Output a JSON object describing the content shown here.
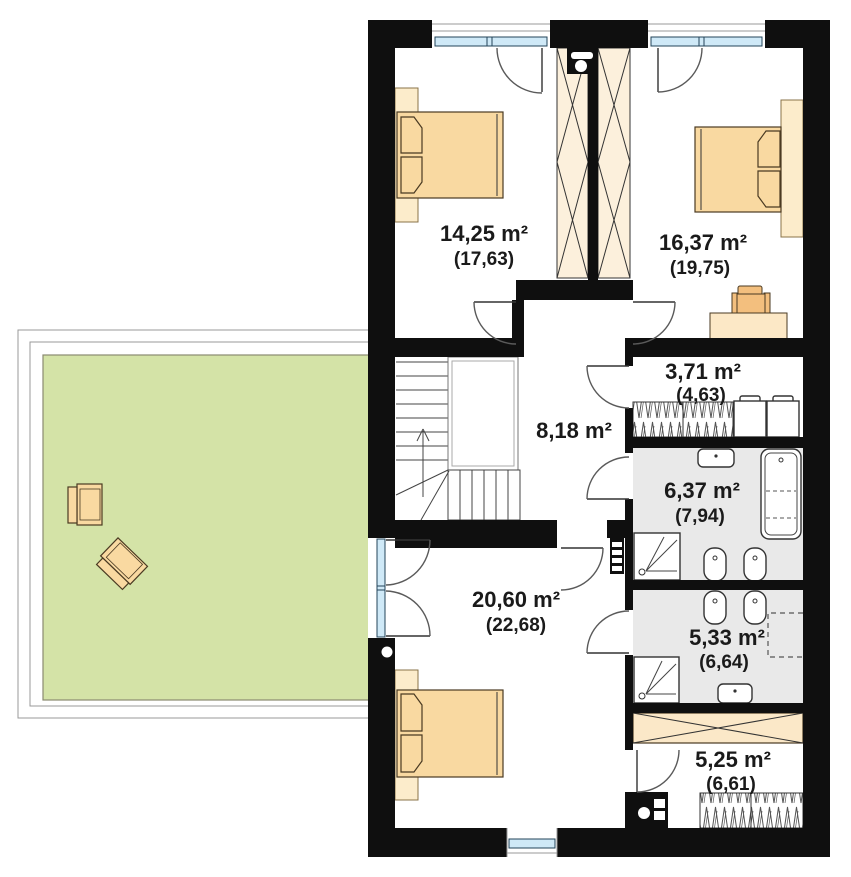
{
  "rooms": {
    "bedroom1": {
      "area": "14,25 m²",
      "attic": "(17,63)"
    },
    "bedroom2": {
      "area": "16,37 m²",
      "attic": "(19,75)"
    },
    "closet": {
      "area": "3,71 m²",
      "attic": "(4,63)"
    },
    "hall": {
      "area": "8,18 m²"
    },
    "bathroom1": {
      "area": "6,37 m²",
      "attic": "(7,94)"
    },
    "bedroom3": {
      "area": "20,60 m²",
      "attic": "(22,68)"
    },
    "bathroom2": {
      "area": "5,33 m²",
      "attic": "(6,64)"
    },
    "wardrobe": {
      "area": "5,25 m²",
      "attic": "(6,61)"
    }
  },
  "colors": {
    "wall": "#0f0f0f",
    "furniture": "#f9d9a1",
    "furniture_light": "#fceccb",
    "wardrobe_fill": "#fcf0dc",
    "terrace_green": "#d4e3a7",
    "bathroom_floor": "#e9e9e9",
    "window_glazing": "#cfe9f7"
  }
}
